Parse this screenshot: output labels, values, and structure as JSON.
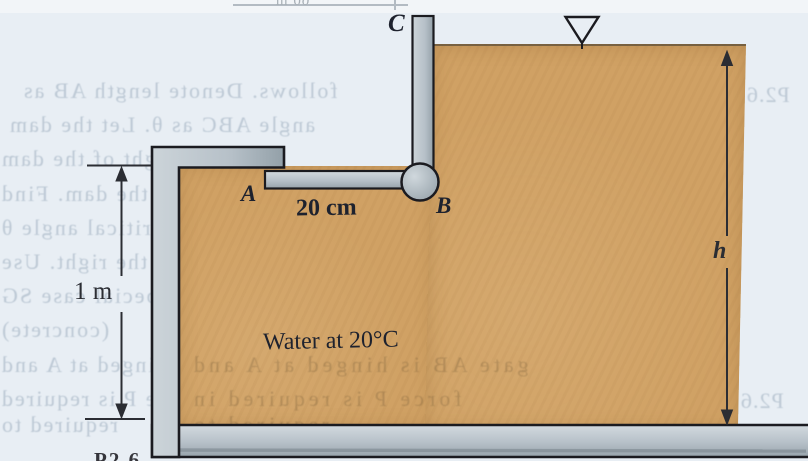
{
  "figure": {
    "description": "Scanned fluid-mechanics textbook figure: L-shaped tank of water with gate ABC hinged at B",
    "point_labels": {
      "a": "A",
      "b": "B",
      "c": "C"
    },
    "labels": {
      "water": "Water at 20°C",
      "dim_ab": "20 cm",
      "dim_left": "1 m",
      "dim_right": "h"
    },
    "fragments": {
      "top_dim": "60 m",
      "bottom_caption": "P2.6"
    },
    "bleed_through": {
      "lines": [
        "follows. Denote length AB as",
        "angle ABC as θ. Let the dam",
        "weight of the dam",
        "over the dam. Find",
        "and the critical angle θ",
        "tip over to the right. Use",
        "for the special case SG",
        "(concrete)",
        "gate AB is hinged at A and",
        "force P is required",
        "required to"
      ],
      "over_water": [
        "gate AB is hinged at A and",
        "force P is required in",
        "required to"
      ],
      "margin_right": [
        "P2.6",
        "P2.6"
      ]
    },
    "colors": {
      "paper": "#e8eef4",
      "paper_top": "#f2f5f8",
      "water": "#d0a164",
      "water_edge": "rgba(90,75,52,0.75)",
      "wall": "#b6c0c8",
      "wall_dark": "#8e9aa2",
      "wall_light": "#d3dadf",
      "outline": "#1b1b20",
      "label": "#1e222e",
      "dim": "#2b2d33",
      "bleed": "#bdc9d5",
      "bleed_dark": "#a9b2ba",
      "bleed_on_water": "rgba(104,82,50,0.28)",
      "caption": "#35353b"
    }
  }
}
